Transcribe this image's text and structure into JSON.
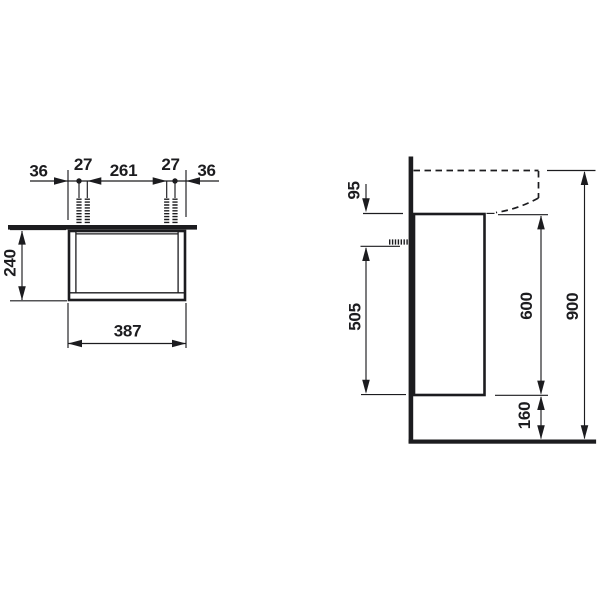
{
  "colors": {
    "line": "#1c1c1f",
    "background": "#ffffff"
  },
  "plan_view": {
    "top_dimensions": [
      {
        "label": "36"
      },
      {
        "label": "27"
      },
      {
        "label": "261"
      },
      {
        "label": "27"
      },
      {
        "label": "36"
      }
    ],
    "depth_dimension": "240",
    "width_dimension": "387"
  },
  "side_view": {
    "basin_front_height_dimension": "95",
    "fixing_to_bottom_dimension": "505",
    "cabinet_height_dimension": "600",
    "total_height_dimension": "900",
    "floor_clearance_dimension": "160"
  }
}
